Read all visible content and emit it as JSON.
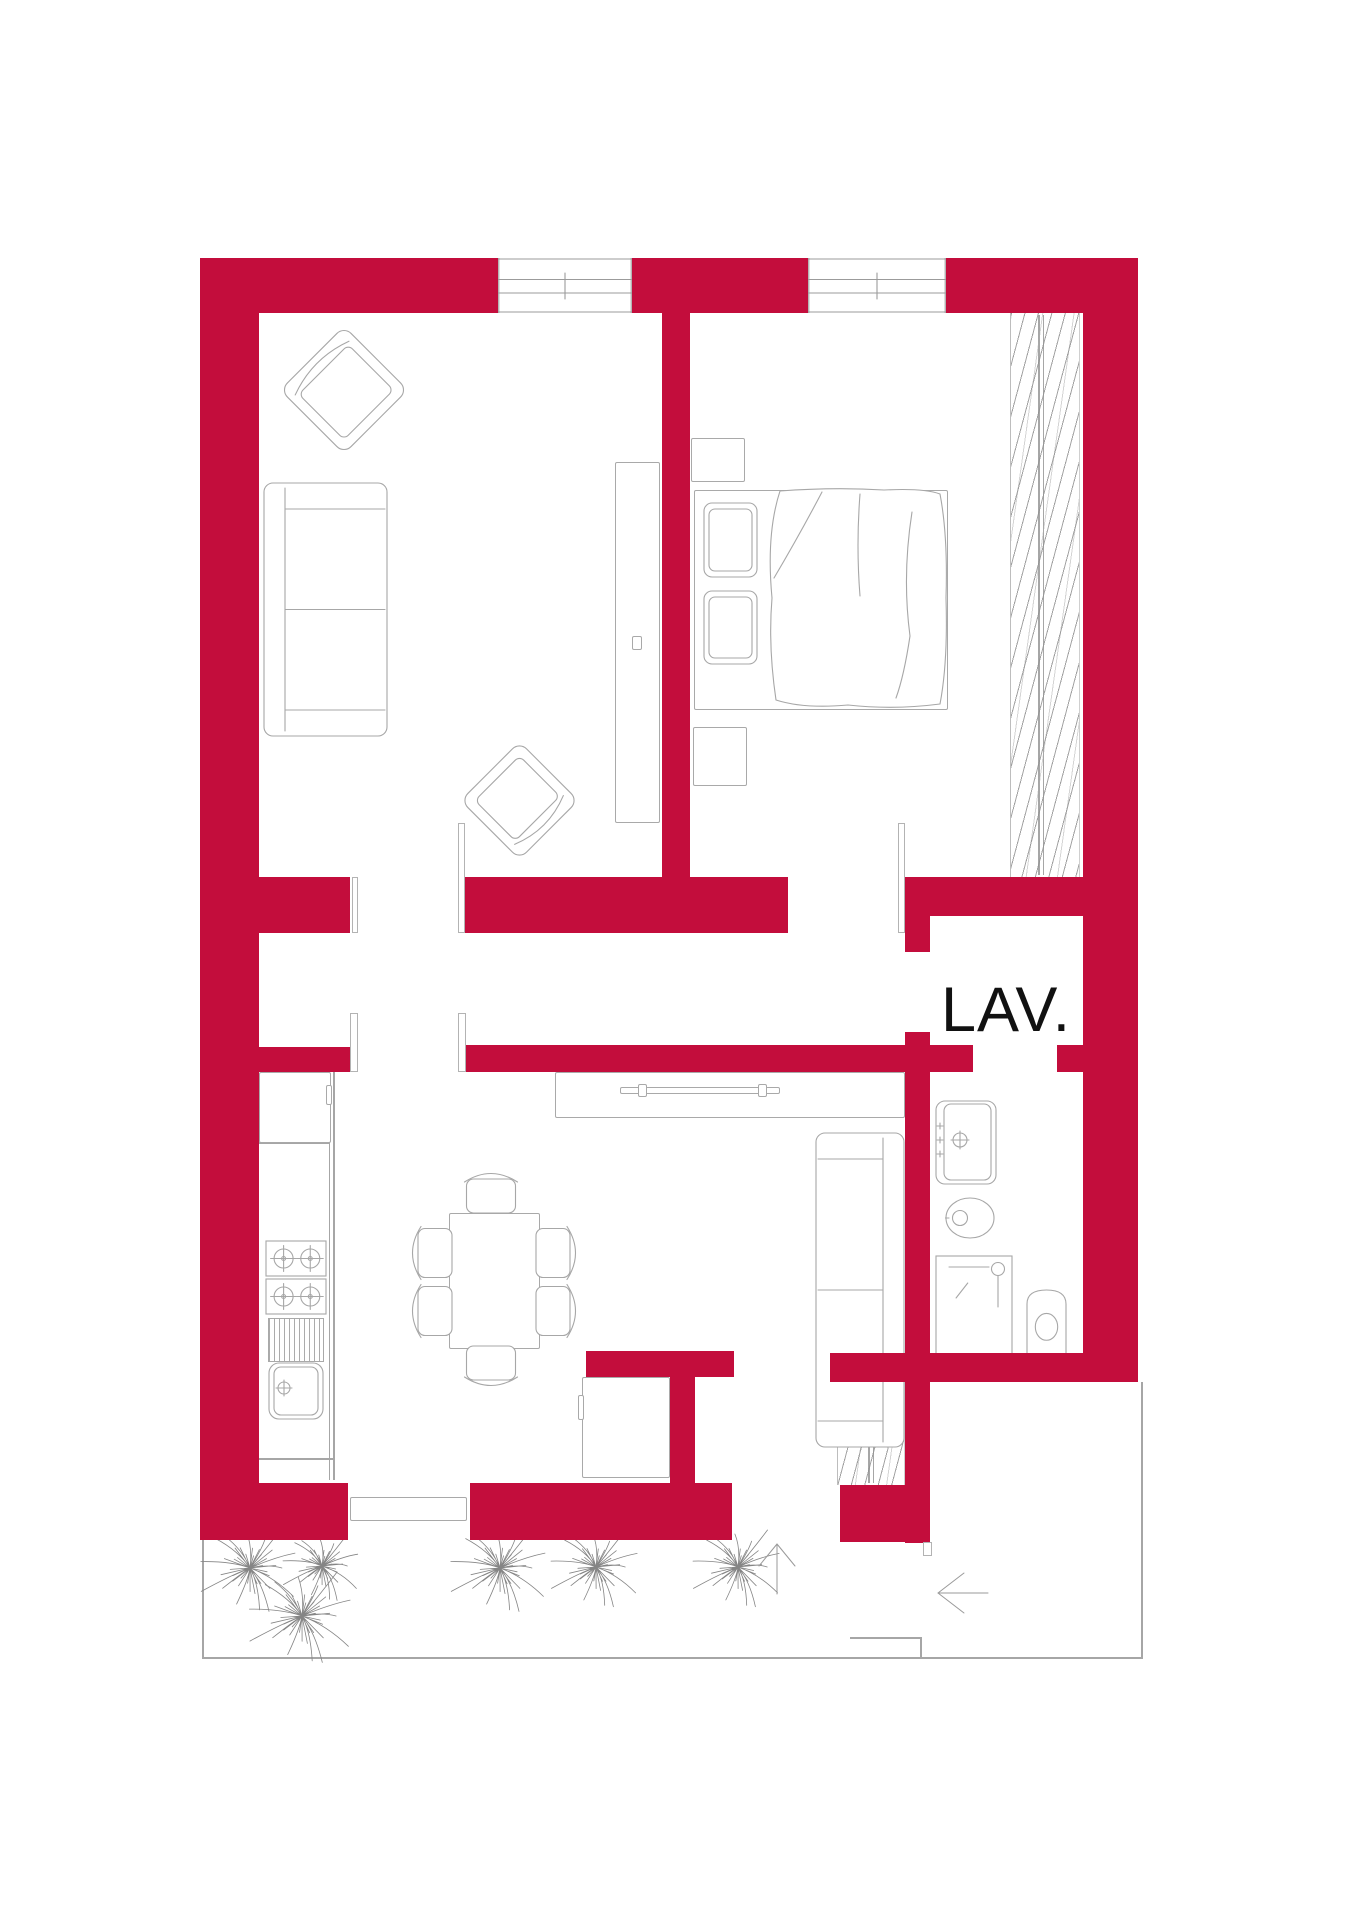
{
  "canvas": {
    "width": 1347,
    "height": 1920,
    "background": "#ffffff"
  },
  "label": {
    "lav": "LAV."
  },
  "colors": {
    "wall": "#c30d3c",
    "line": "#a6a6a6",
    "furniture": "#a9a9a9",
    "plant": "#858585",
    "text": "#111111"
  },
  "elements": [
    {
      "t": "wall",
      "n": "wall-top-left",
      "x": 200,
      "y": 258,
      "w": 298,
      "h": 55
    },
    {
      "t": "wall",
      "n": "wall-top-middle",
      "x": 632,
      "y": 258,
      "w": 176,
      "h": 55
    },
    {
      "t": "wall",
      "n": "wall-top-right",
      "x": 946,
      "y": 258,
      "w": 192,
      "h": 55
    },
    {
      "t": "wall",
      "n": "wall-left",
      "x": 200,
      "y": 258,
      "w": 59,
      "h": 1282
    },
    {
      "t": "wall",
      "n": "wall-right",
      "x": 1083,
      "y": 258,
      "w": 55,
      "h": 1124
    },
    {
      "t": "wall",
      "n": "wall-divider-living-bedroom",
      "x": 662,
      "y": 313,
      "w": 28,
      "h": 567
    },
    {
      "t": "wall",
      "n": "wall-stub-upper-left",
      "x": 259,
      "y": 877,
      "w": 91,
      "h": 56
    },
    {
      "t": "wall",
      "n": "wall-mid-upper",
      "x": 465,
      "y": 877,
      "w": 323,
      "h": 56
    },
    {
      "t": "wall",
      "n": "wall-bedroom-bottom",
      "x": 905,
      "y": 877,
      "w": 180,
      "h": 39
    },
    {
      "t": "wall",
      "n": "wall-lav-west-upper",
      "x": 905,
      "y": 877,
      "w": 25,
      "h": 75
    },
    {
      "t": "wall",
      "n": "wall-stub-lower-left",
      "x": 259,
      "y": 1047,
      "w": 91,
      "h": 25
    },
    {
      "t": "wall",
      "n": "wall-mid-lower",
      "x": 465,
      "y": 1045,
      "w": 508,
      "h": 27
    },
    {
      "t": "wall",
      "n": "wall-lav-east-block",
      "x": 1057,
      "y": 1045,
      "w": 26,
      "h": 27
    },
    {
      "t": "wall",
      "n": "wall-lav-west-lower",
      "x": 905,
      "y": 1032,
      "w": 25,
      "h": 511
    },
    {
      "t": "wall",
      "n": "wall-bath-bottom",
      "x": 830,
      "y": 1353,
      "w": 308,
      "h": 29
    },
    {
      "t": "wall",
      "n": "wall-entry-block",
      "x": 840,
      "y": 1485,
      "w": 88,
      "h": 57
    },
    {
      "t": "wall",
      "n": "wall-bottom-left",
      "x": 200,
      "y": 1483,
      "w": 148,
      "h": 57
    },
    {
      "t": "wall",
      "n": "wall-bottom-kitchen",
      "x": 470,
      "y": 1483,
      "w": 262,
      "h": 57
    },
    {
      "t": "wall",
      "n": "wall-dining-el-horizontal",
      "x": 586,
      "y": 1351,
      "w": 148,
      "h": 26
    },
    {
      "t": "wall",
      "n": "wall-dining-el-vertical",
      "x": 670,
      "y": 1377,
      "w": 25,
      "h": 106
    },
    {
      "t": "window",
      "n": "window-living-room",
      "x": 498,
      "y": 258,
      "w": 134,
      "h": 55,
      "z": 4
    },
    {
      "t": "window",
      "n": "window-bedroom",
      "x": 808,
      "y": 258,
      "w": 138,
      "h": 55,
      "z": 4
    },
    {
      "t": "jamb",
      "n": "door-jamb-living-left",
      "x": 352,
      "y": 877,
      "w": 6,
      "h": 56
    },
    {
      "t": "jamb",
      "n": "door-jamb-living-right",
      "x": 458,
      "y": 823,
      "w": 7,
      "h": 110
    },
    {
      "t": "jamb",
      "n": "door-jamb-kitchen-left",
      "x": 350,
      "y": 1013,
      "w": 8,
      "h": 59
    },
    {
      "t": "jamb",
      "n": "door-jamb-kitchen-right",
      "x": 458,
      "y": 1013,
      "w": 8,
      "h": 59
    },
    {
      "t": "jamb",
      "n": "door-jamb-bedroom",
      "x": 898,
      "y": 823,
      "w": 7,
      "h": 110
    },
    {
      "t": "jamb",
      "n": "door-jamb-entry",
      "x": 923,
      "y": 1542,
      "w": 9,
      "h": 14
    },
    {
      "t": "ln",
      "n": "terrace-edge-bottom",
      "x": 202,
      "y": 1657,
      "w": 941,
      "h": 2
    },
    {
      "t": "ln",
      "n": "terrace-edge-left",
      "x": 202,
      "y": 1540,
      "w": 2,
      "h": 119
    },
    {
      "t": "ln",
      "n": "terrace-edge-right",
      "x": 1141,
      "y": 1382,
      "w": 2,
      "h": 277
    },
    {
      "t": "ln",
      "n": "entry-step-top",
      "x": 850,
      "y": 1637,
      "w": 72,
      "h": 2
    },
    {
      "t": "ln",
      "n": "entry-step-side",
      "x": 920,
      "y": 1637,
      "w": 2,
      "h": 22
    },
    {
      "t": "ln",
      "n": "kitchen-counter-edge-outer",
      "x": 333,
      "y": 1072,
      "w": 2,
      "h": 408
    },
    {
      "t": "ln",
      "n": "kitchen-counter-edge-inner",
      "x": 329,
      "y": 1072,
      "w": 1,
      "h": 408
    },
    {
      "t": "ln",
      "n": "kitchen-counter-end",
      "x": 259,
      "y": 1458,
      "w": 74,
      "h": 2
    },
    {
      "t": "ln",
      "n": "kitchen-counter-divider",
      "x": 259,
      "y": 1142,
      "w": 71,
      "h": 2
    },
    {
      "t": "ln",
      "n": "wardrobe-rail-a",
      "x": 1038,
      "y": 315,
      "w": 2,
      "h": 560
    },
    {
      "t": "ln",
      "n": "wardrobe-rail-b",
      "x": 1043,
      "y": 315,
      "w": 1,
      "h": 560
    },
    {
      "t": "ln",
      "n": "entry-closet-rail-a",
      "x": 868,
      "y": 1384,
      "w": 2,
      "h": 99
    },
    {
      "t": "ln",
      "n": "entry-closet-rail-b",
      "x": 873,
      "y": 1384,
      "w": 1,
      "h": 99
    },
    {
      "t": "ln",
      "n": "bed-headboard-line",
      "x": 704,
      "y": 492,
      "w": 2,
      "h": 216
    },
    {
      "t": "ln",
      "n": "tv-unit-groove",
      "x": 637,
      "y": 470,
      "w": 1,
      "h": 345
    },
    {
      "t": "ln",
      "n": "sliding-door-divider-v",
      "x": 408,
      "y": 1497,
      "w": 1,
      "h": 24
    },
    {
      "t": "ln",
      "n": "sliding-door-divider-h",
      "x": 350,
      "y": 1509,
      "w": 117,
      "h": 1
    },
    {
      "t": "rc",
      "n": "sliding-door-panel",
      "x": 350,
      "y": 1497,
      "w": 117,
      "h": 24
    },
    {
      "t": "rc",
      "n": "tv-unit",
      "x": 615,
      "y": 462,
      "w": 45,
      "h": 361
    },
    {
      "t": "rc",
      "n": "tv-unit-knob",
      "x": 632,
      "y": 636,
      "w": 10,
      "h": 14
    },
    {
      "t": "rc",
      "n": "nightstand-top",
      "x": 691,
      "y": 438,
      "w": 54,
      "h": 44
    },
    {
      "t": "rc",
      "n": "nightstand-bottom",
      "x": 693,
      "y": 727,
      "w": 54,
      "h": 59
    },
    {
      "t": "rc",
      "n": "bed-frame",
      "x": 694,
      "y": 490,
      "w": 254,
      "h": 220
    },
    {
      "t": "rc",
      "n": "corridor-niche",
      "x": 555,
      "y": 1072,
      "w": 350,
      "h": 46
    },
    {
      "t": "rc",
      "n": "corridor-niche-bar",
      "x": 620,
      "y": 1087,
      "w": 160,
      "h": 7
    },
    {
      "t": "rc",
      "n": "corridor-niche-clip-a",
      "x": 638,
      "y": 1084,
      "w": 9,
      "h": 13
    },
    {
      "t": "rc",
      "n": "corridor-niche-clip-b",
      "x": 758,
      "y": 1084,
      "w": 9,
      "h": 13
    },
    {
      "t": "rc",
      "n": "kitchen-tall-cabinet",
      "x": 259,
      "y": 1072,
      "w": 72,
      "h": 71
    },
    {
      "t": "rc",
      "n": "kitchen-cabinet-handle",
      "x": 326,
      "y": 1085,
      "w": 6,
      "h": 20
    },
    {
      "t": "rc",
      "n": "fridge-cabinet",
      "x": 582,
      "y": 1377,
      "w": 88,
      "h": 101
    },
    {
      "t": "rc",
      "n": "fridge-handle",
      "x": 578,
      "y": 1395,
      "w": 6,
      "h": 25
    },
    {
      "t": "rc",
      "n": "dining-table",
      "x": 449,
      "y": 1213,
      "w": 91,
      "h": 136
    },
    {
      "t": "hatch",
      "n": "wardrobe-hatch",
      "x": 1010,
      "y": 313,
      "w": 70,
      "h": 564
    },
    {
      "t": "hatch",
      "n": "entry-closet-hatch",
      "x": 837,
      "y": 1382,
      "w": 68,
      "h": 103
    },
    {
      "t": "stripes",
      "n": "dish-drainer",
      "x": 268,
      "y": 1318,
      "w": 56,
      "h": 44
    },
    {
      "t": "sofa",
      "n": "sofa-living-room",
      "x": 263,
      "y": 482,
      "w": 125,
      "h": 255,
      "b": "left"
    },
    {
      "t": "sofa",
      "n": "sofa-dining",
      "x": 815,
      "y": 1132,
      "w": 90,
      "h": 316,
      "b": "right"
    },
    {
      "t": "armchair",
      "n": "armchair-living-1",
      "x": 298,
      "y": 344,
      "w": 92,
      "h": 92,
      "r": -45
    },
    {
      "t": "armchair",
      "n": "armchair-living-2",
      "x": 477,
      "y": 758,
      "w": 85,
      "h": 85,
      "r": 135
    },
    {
      "t": "chair",
      "n": "dining-chair-top",
      "x": 462,
      "y": 1170,
      "w": 58,
      "h": 44,
      "r": 0
    },
    {
      "t": "chair",
      "n": "dining-chair-bottom",
      "x": 462,
      "y": 1345,
      "w": 58,
      "h": 44,
      "r": 180
    },
    {
      "t": "chair",
      "n": "dining-chair-left-1",
      "x": 402,
      "y": 1231,
      "w": 58,
      "h": 44,
      "r": -90
    },
    {
      "t": "chair",
      "n": "dining-chair-left-2",
      "x": 402,
      "y": 1289,
      "w": 58,
      "h": 44,
      "r": -90
    },
    {
      "t": "chair",
      "n": "dining-chair-right-1",
      "x": 528,
      "y": 1231,
      "w": 58,
      "h": 44,
      "r": 90
    },
    {
      "t": "chair",
      "n": "dining-chair-right-2",
      "x": 528,
      "y": 1289,
      "w": 58,
      "h": 44,
      "r": 90
    },
    {
      "t": "stove",
      "n": "stove-burners-top",
      "x": 265,
      "y": 1240,
      "w": 62,
      "h": 37
    },
    {
      "t": "stove",
      "n": "stove-burners-bottom",
      "x": 265,
      "y": 1278,
      "w": 62,
      "h": 37
    },
    {
      "t": "sink",
      "n": "kitchen-sink",
      "x": 268,
      "y": 1362,
      "w": 56,
      "h": 58
    },
    {
      "t": "basin",
      "n": "bathroom-washbasin",
      "x": 935,
      "y": 1100,
      "w": 62,
      "h": 85
    },
    {
      "t": "bidet",
      "n": "bathroom-bidet",
      "x": 945,
      "y": 1197,
      "w": 50,
      "h": 42
    },
    {
      "t": "toilet",
      "n": "bathroom-toilet",
      "x": 1025,
      "y": 1288,
      "w": 43,
      "h": 67
    },
    {
      "t": "shower",
      "n": "bathroom-shower",
      "x": 935,
      "y": 1255,
      "w": 78,
      "h": 100
    },
    {
      "t": "duvet",
      "n": "bed-duvet",
      "x": 764,
      "y": 486,
      "w": 188,
      "h": 226
    },
    {
      "t": "pillow",
      "n": "bed-pillow-1",
      "x": 703,
      "y": 502,
      "w": 55,
      "h": 76
    },
    {
      "t": "pillow",
      "n": "bed-pillow-2",
      "x": 703,
      "y": 590,
      "w": 55,
      "h": 75
    },
    {
      "t": "plant",
      "n": "terrace-plant-1",
      "x": 192,
      "y": 1510,
      "w": 116,
      "h": 116
    },
    {
      "t": "plant",
      "n": "terrace-plant-2",
      "x": 240,
      "y": 1554,
      "w": 124,
      "h": 124
    },
    {
      "t": "plant",
      "n": "terrace-plant-3",
      "x": 276,
      "y": 1520,
      "w": 92,
      "h": 92
    },
    {
      "t": "plant",
      "n": "terrace-plant-4",
      "x": 442,
      "y": 1510,
      "w": 116,
      "h": 116
    },
    {
      "t": "plant",
      "n": "terrace-plant-5",
      "x": 543,
      "y": 1514,
      "w": 106,
      "h": 106
    },
    {
      "t": "plant",
      "n": "terrace-plant-6",
      "x": 685,
      "y": 1514,
      "w": 106,
      "h": 106
    },
    {
      "t": "arrowup",
      "n": "entry-arrow-up",
      "x": 757,
      "y": 1542,
      "w": 40,
      "h": 54
    },
    {
      "t": "arrowleft",
      "n": "entry-arrow-left",
      "x": 936,
      "y": 1570,
      "w": 54,
      "h": 46
    }
  ]
}
